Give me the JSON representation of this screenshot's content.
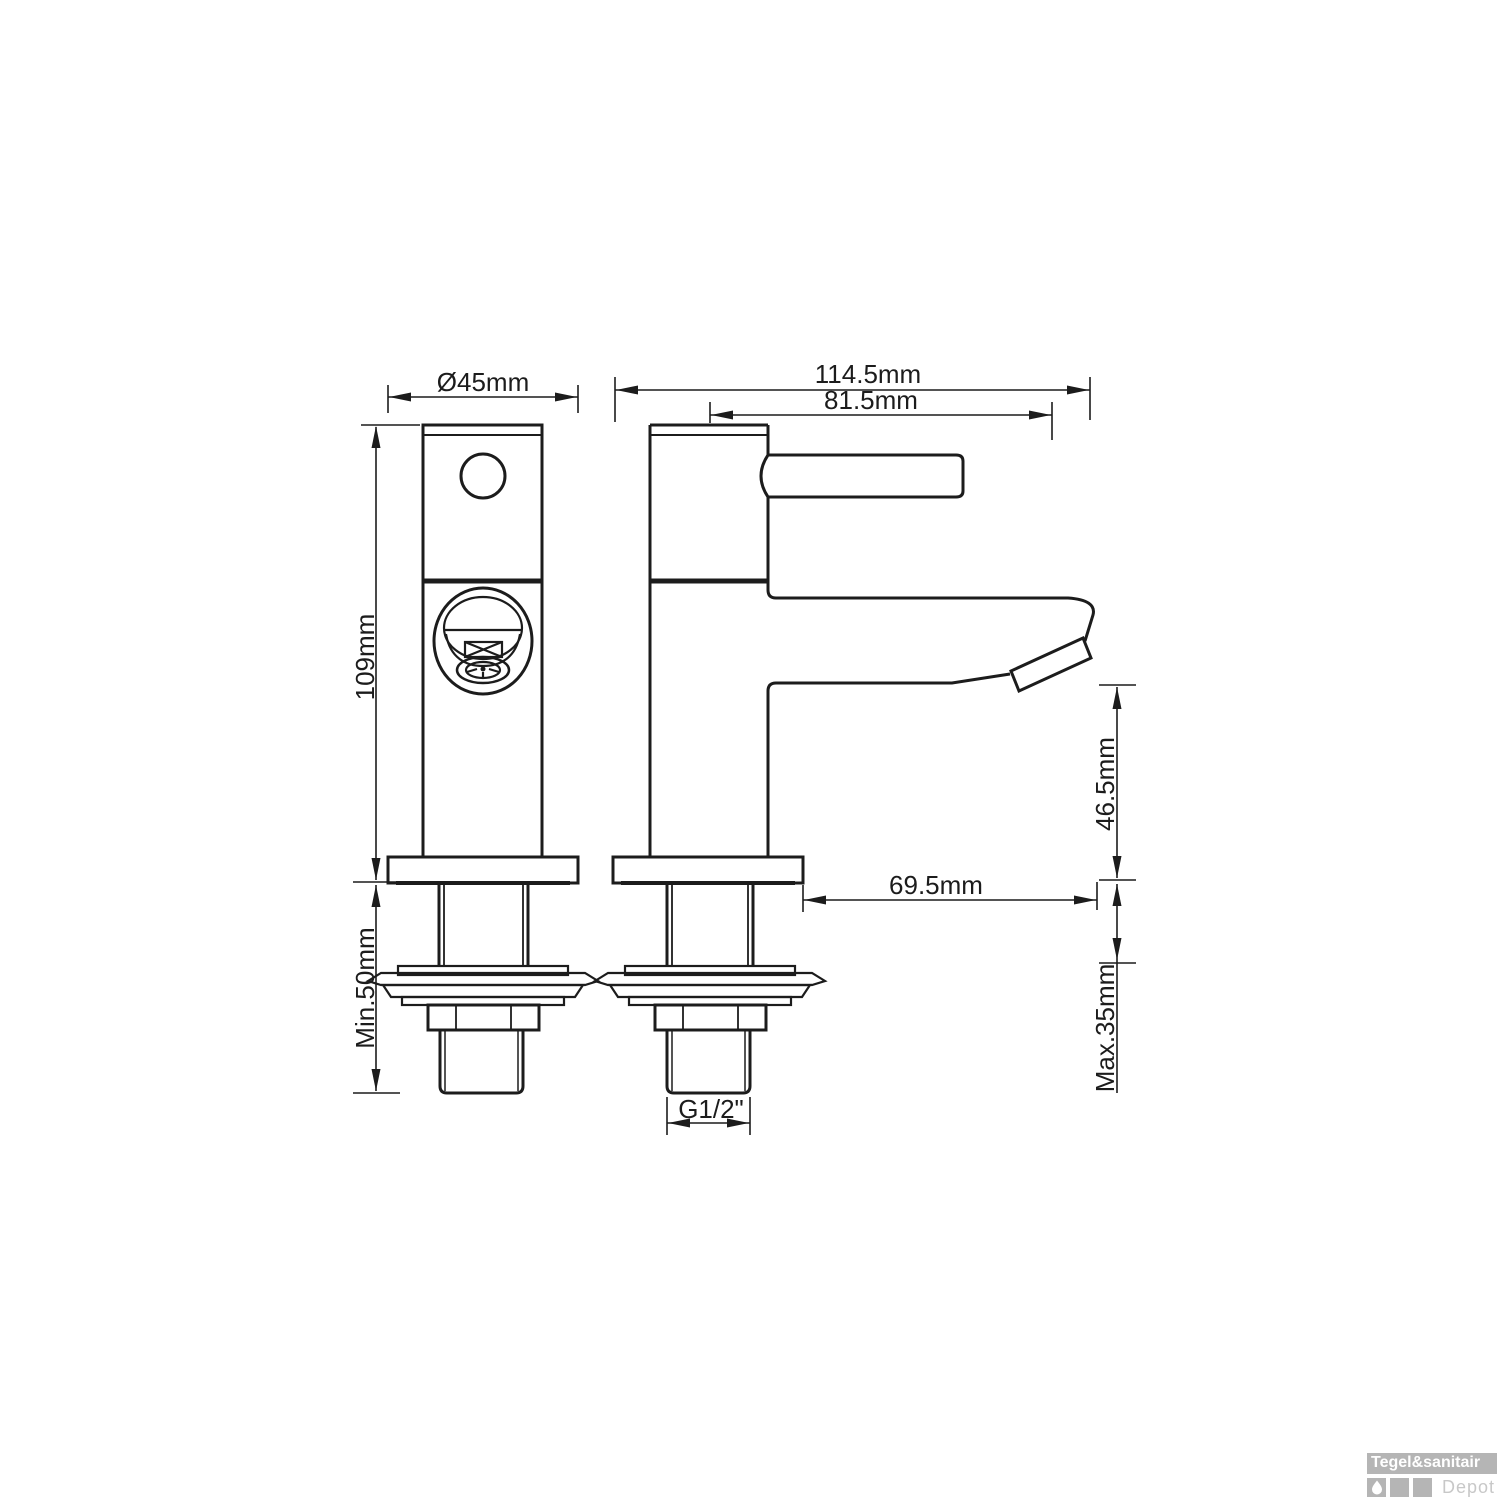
{
  "drawing": {
    "front_view": {
      "diameter": "Ø45mm",
      "height": "109mm",
      "min_install_depth": "Min.50mm"
    },
    "side_view": {
      "total_depth": "114.5mm",
      "handle_reach": "81.5mm",
      "spout_height": "46.5mm",
      "spout_reach": "69.5mm",
      "max_deck_thickness": "Max.35mm",
      "thread_size": "G1/2\""
    }
  },
  "watermark": {
    "brand": "Tegel&sanitair",
    "brand_suffix": "Depot"
  },
  "colors": {
    "line": "#1c1c1c",
    "background": "#ffffff",
    "watermark_gray": "#b5b5b5",
    "watermark_text": "#ffffff",
    "watermark_depot": "#c8c8c8"
  }
}
